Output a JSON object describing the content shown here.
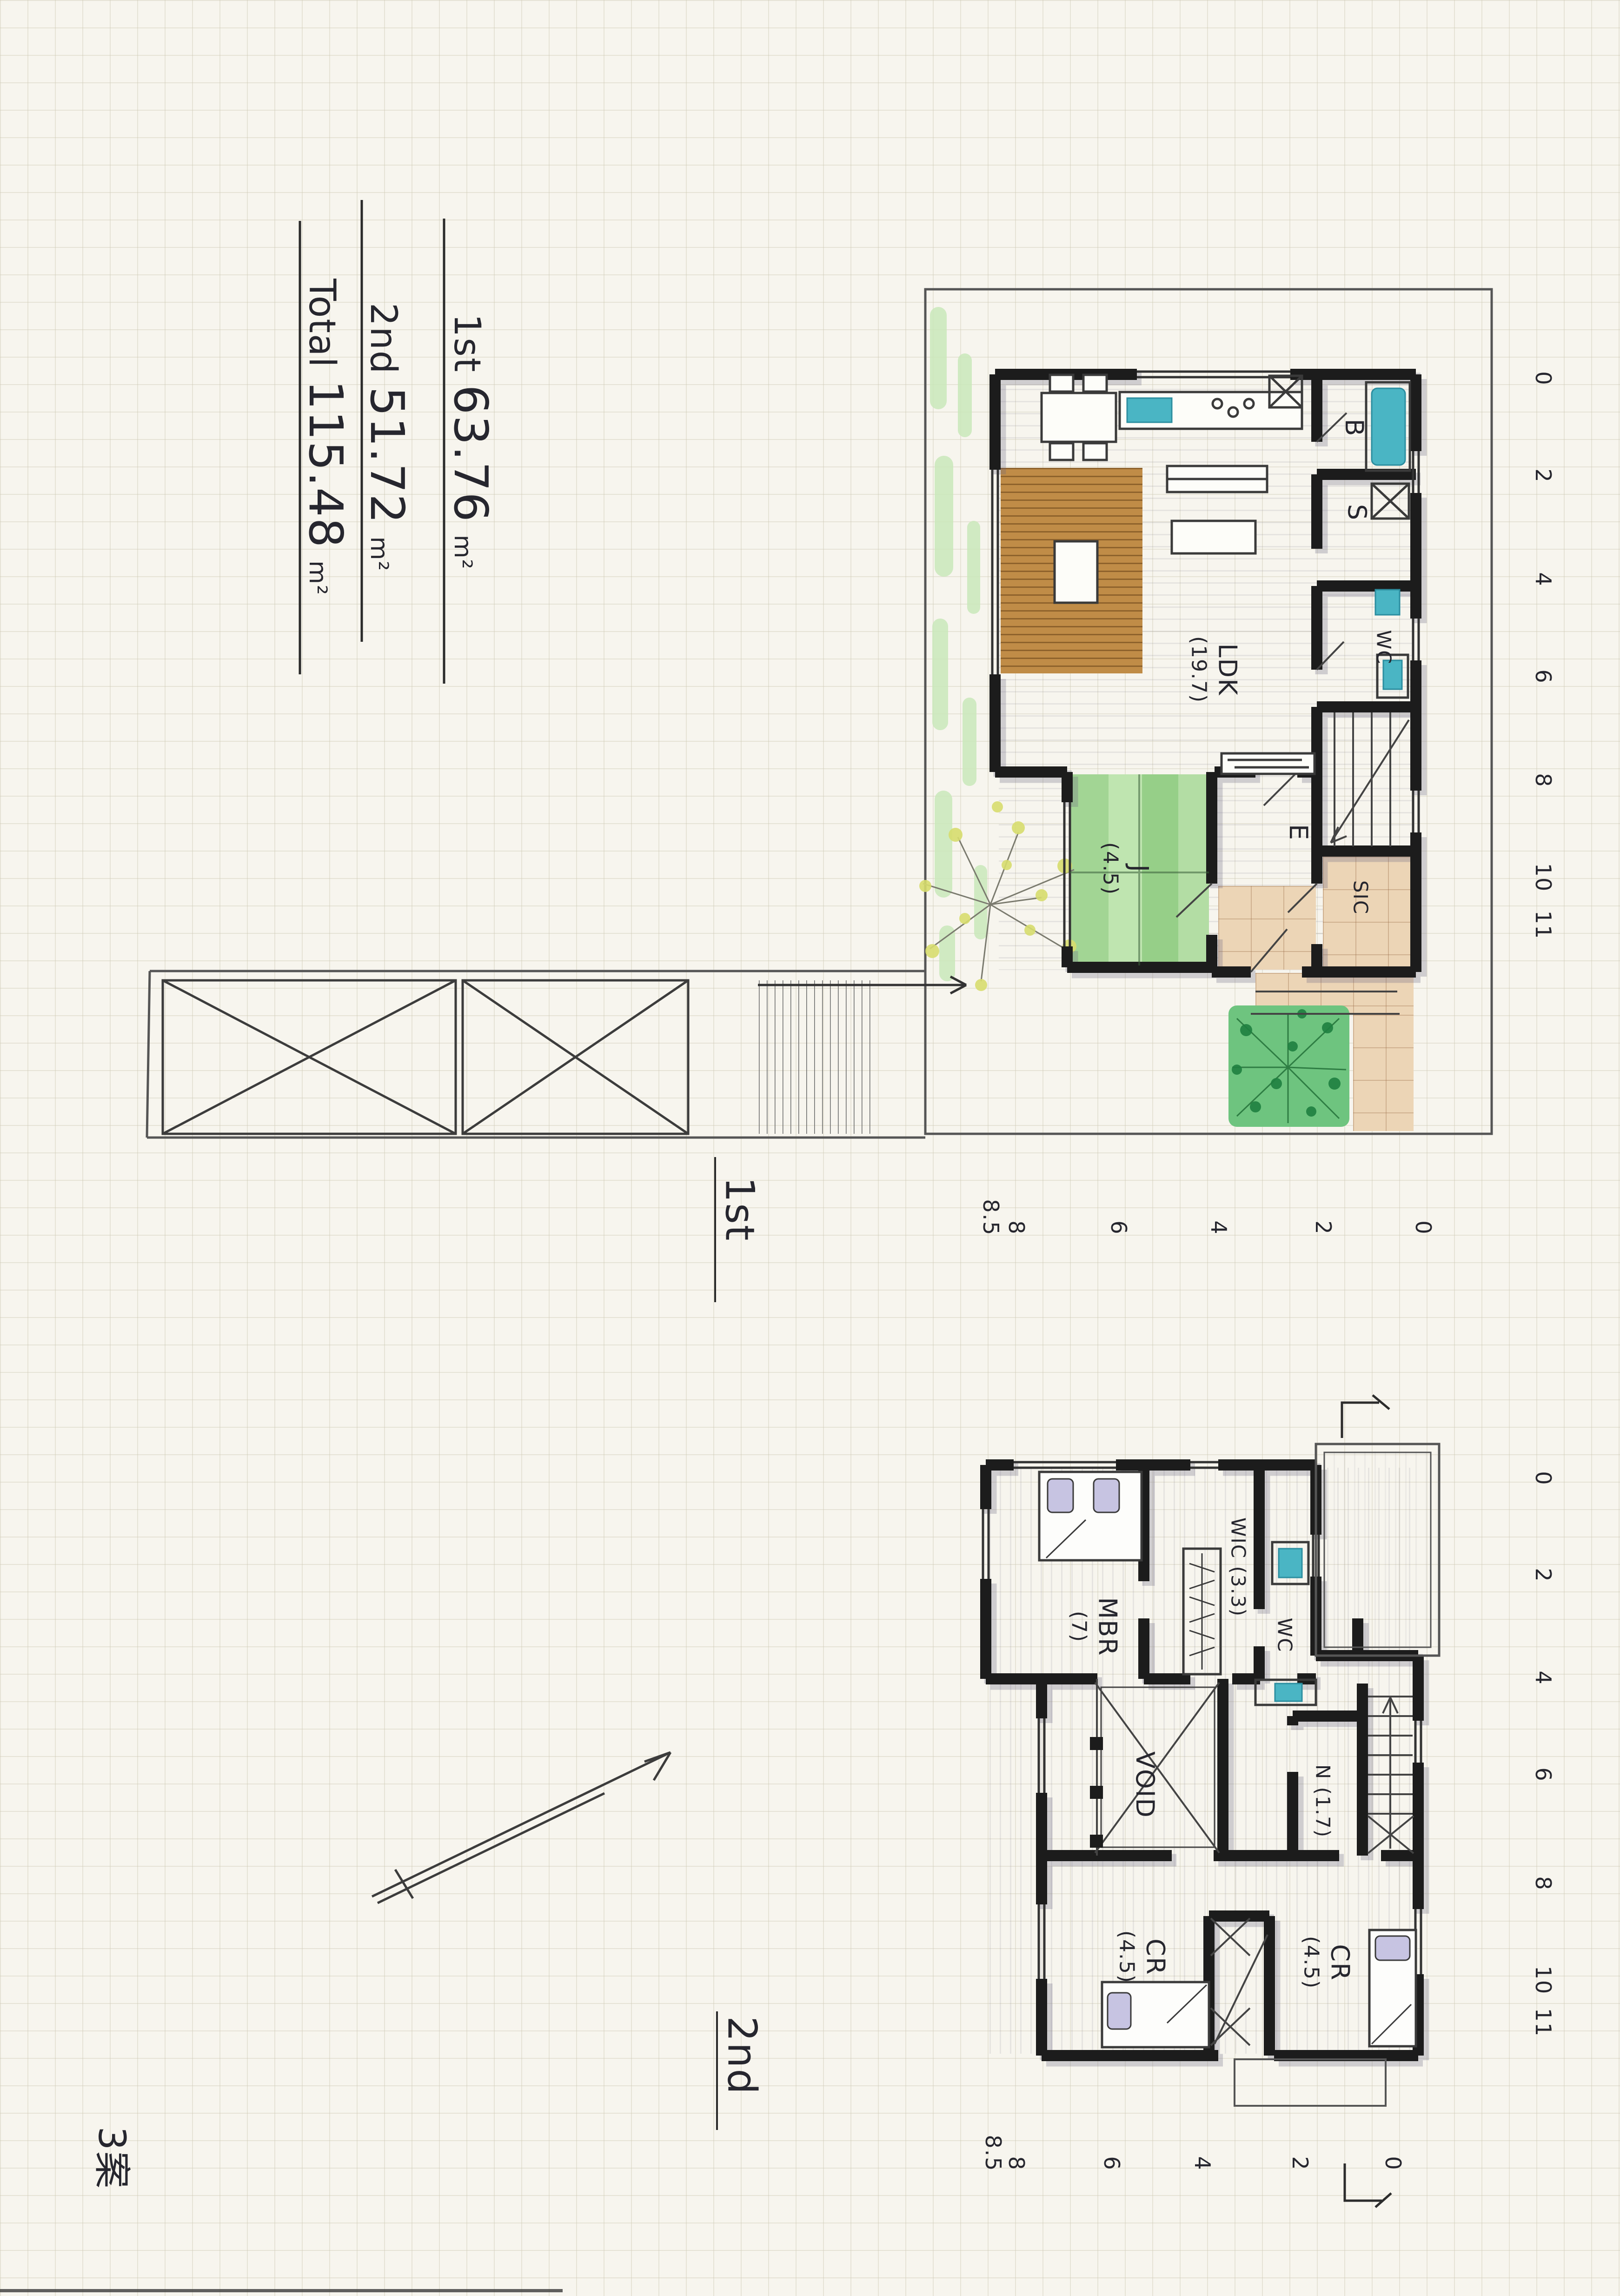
{
  "sheet": {
    "area_summary": [
      {
        "label": "1st",
        "value": "63.76",
        "unit": "m²"
      },
      {
        "label": "2nd",
        "value": "51.72",
        "unit": "m²"
      },
      {
        "label": "Total",
        "value": "115.48",
        "unit": "m²"
      }
    ],
    "note_bottom_left": "3案"
  },
  "floor1": {
    "name_label": "1st",
    "rooms": {
      "ldk": {
        "label": "LDK",
        "area": "(19.7)"
      },
      "j": {
        "label": "J",
        "area": "(4.5)"
      },
      "b": {
        "label": "B"
      },
      "s": {
        "label": "S"
      },
      "wc": {
        "label": "WC"
      },
      "e": {
        "label": "E"
      },
      "sic": {
        "label": "SIC"
      }
    },
    "ruler_right": [
      "0",
      "2",
      "4",
      "6",
      "8",
      "10",
      "11"
    ],
    "ruler_bottom": [
      "8.5",
      "8",
      "6",
      "4",
      "2",
      "0"
    ]
  },
  "floor2": {
    "name_label": "2nd",
    "rooms": {
      "mbr": {
        "label": "MBR",
        "area": "(7)"
      },
      "wic": {
        "label": "WIC (3.3)"
      },
      "wc": {
        "label": "WC"
      },
      "void": {
        "label": "VOID"
      },
      "n": {
        "label": "N (1.7)"
      },
      "cr1": {
        "label": "CR",
        "area": "(4.5)"
      },
      "cr2": {
        "label": "CR",
        "area": "(4.5)"
      }
    },
    "ruler_right": [
      "0",
      "2",
      "4",
      "6",
      "8",
      "10",
      "11"
    ],
    "ruler_bottom": [
      "8.5",
      "8",
      "6",
      "4",
      "2",
      "0"
    ]
  },
  "colors": {
    "paper": "#f7f5ee",
    "ink": "#1c1c1c",
    "pencil": "#8e8a99",
    "water_teal": "#4ab5c4",
    "tatami_green": "#97d292",
    "garden_green": "#49b061",
    "deck_brown": "#bf8f4f",
    "tile_beige": "#e8d0b0",
    "pillow_lavender": "#c7c4e2"
  }
}
